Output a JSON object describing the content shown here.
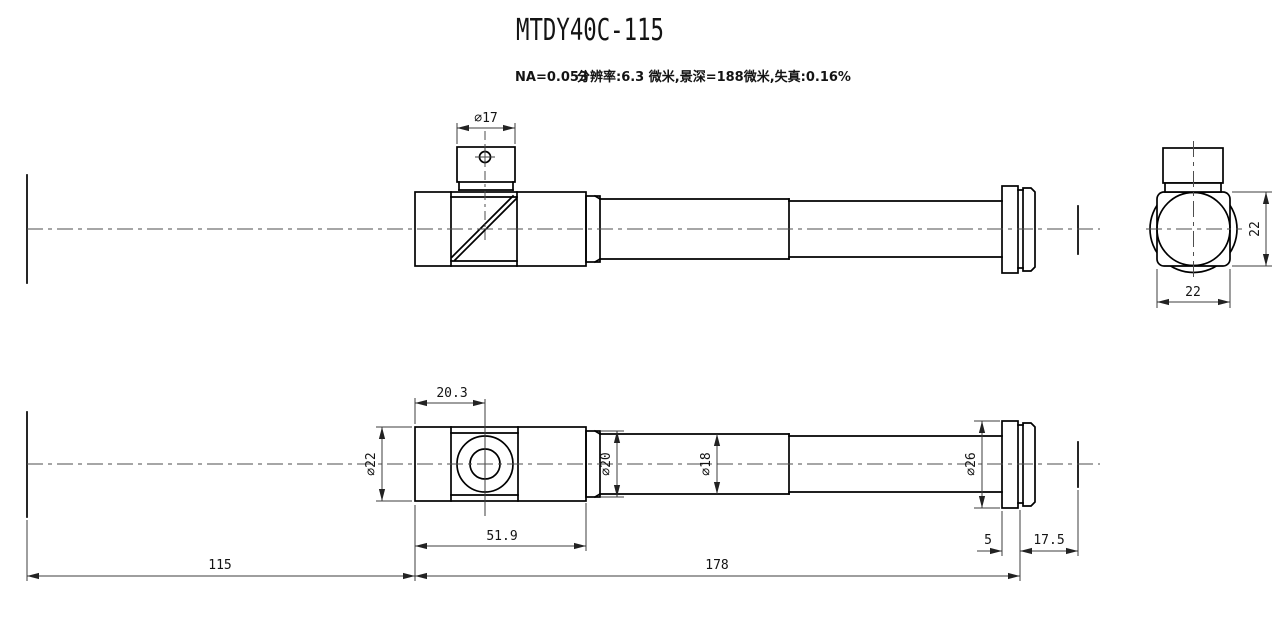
{
  "header": {
    "title": "MTDY40C-115",
    "na_spec": "NA=0.053",
    "optics_spec": "分辨率:6.3 微米,景深=188微米,失真:0.16%"
  },
  "dims": {
    "port_diameter": "∅17",
    "end_width": "22",
    "end_height": "22",
    "hole_offset": "20.3",
    "body_diameter": "∅22",
    "body_length": "51.9",
    "collar_diameter": "∅20",
    "tube_diameter": "∅18",
    "flange_diameter": "∅26",
    "flange_width": "5",
    "flange_to_focus": "17.5",
    "object_distance": "115",
    "tube_length": "178"
  },
  "line_color": "#000000",
  "background": "#ffffff"
}
